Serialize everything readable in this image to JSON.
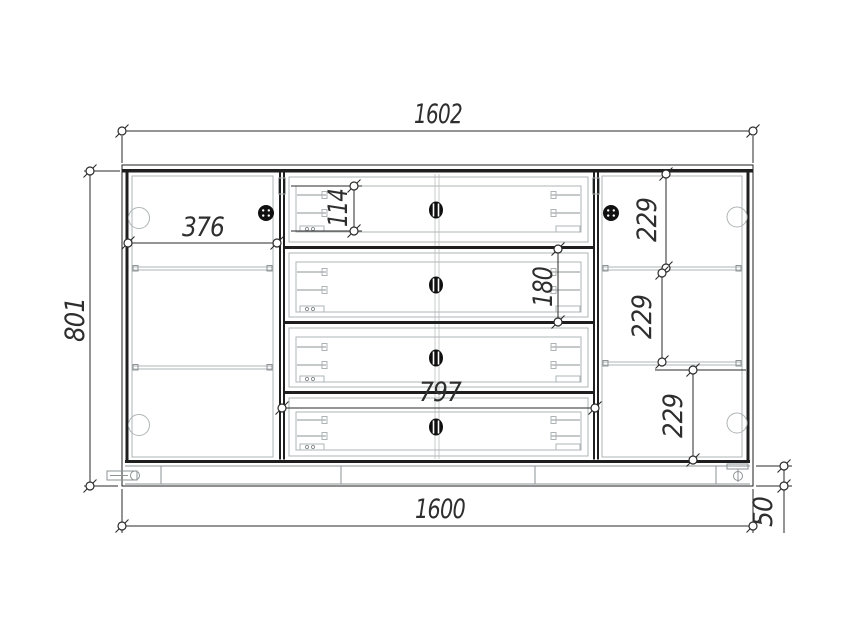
{
  "drawing": {
    "type": "furniture-front-elevation",
    "dimensions": {
      "overall_width": "1602",
      "overall_height": "801",
      "left_door_width": "376",
      "top_drawer_height": "114",
      "second_drawer_height": "180",
      "right_section_top": "229",
      "right_section_middle": "229",
      "right_section_bottom": "229",
      "drawer_bank_width": "797",
      "base_width": "1600",
      "plinth_height": "50"
    },
    "colors": {
      "line": "#1f1f1f",
      "hardware_gray": "#aeb4b4",
      "dimension_text": "#2e2e2e",
      "background": "#ffffff"
    }
  }
}
